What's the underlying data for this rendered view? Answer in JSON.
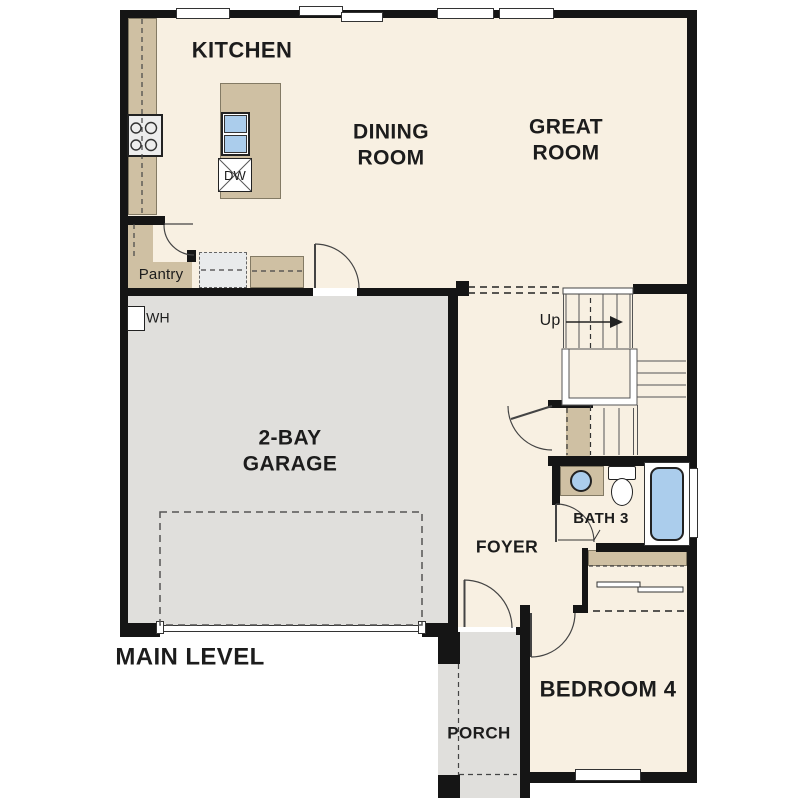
{
  "plan": {
    "title": "MAIN LEVEL",
    "rooms": {
      "kitchen": "KITCHEN",
      "dining": "DINING ROOM",
      "great": "GREAT ROOM",
      "garage": "2-BAY GARAGE",
      "pantry": "Pantry",
      "foyer": "FOYER",
      "bath": "BATH 3",
      "bedroom": "BEDROOM 4",
      "porch": "PORCH"
    },
    "annotations": {
      "water_heater": "WH",
      "dishwasher": "DW",
      "stairs_up": "Up"
    },
    "colors": {
      "floor": "#f8f0e2",
      "hard": "#e0dfdc",
      "cabinet": "#cfc0a3",
      "fixture": "#abcdec",
      "wall": "#151515"
    }
  }
}
